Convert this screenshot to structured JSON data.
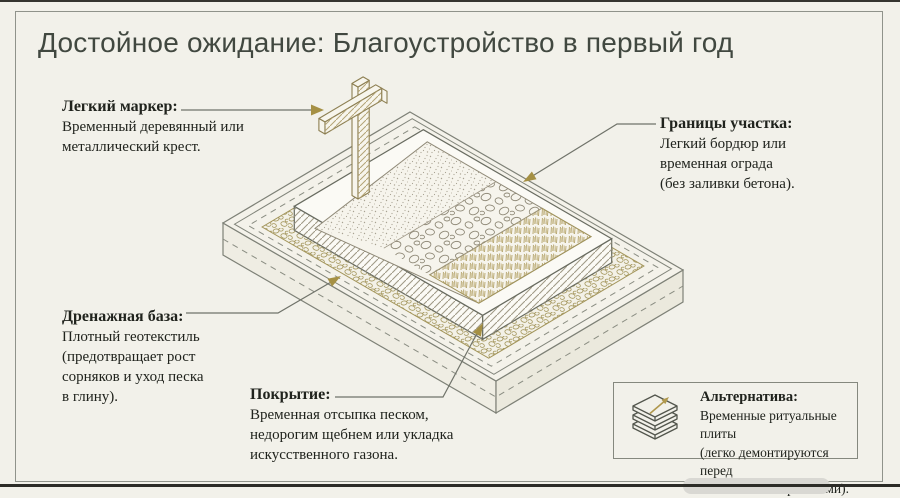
{
  "page": {
    "title": "Достойное ожидание: Благоустройство в первый год"
  },
  "callouts": {
    "marker": {
      "heading": "Легкий маркер:",
      "lines": [
        "Временный деревянный или",
        "металлический крест."
      ]
    },
    "plot_borders": {
      "heading": "Границы участка:",
      "lines": [
        "Легкий бордюр или",
        "временная ограда",
        "(без заливки бетона)."
      ]
    },
    "drainage": {
      "heading": "Дренажная база:",
      "lines": [
        "Плотный геотекстиль",
        "(предотвращает рост",
        "сорняков и уход песка",
        "в глину)."
      ]
    },
    "covering": {
      "heading": "Покрытие:",
      "lines": [
        "Временная отсыпка песком,",
        "недорогим щебнем или укладка",
        "искусственного газона."
      ]
    },
    "alternative": {
      "heading": "Альтернатива:",
      "lines": [
        "Временные ритуальные плиты",
        "(легко демонтируются перед",
        "капитальными работами)."
      ]
    }
  },
  "icons": {
    "cross": "wooden-cross-icon",
    "stacked_slabs": "stacked-slabs-icon",
    "arrow_up_right": "arrow-up-right-icon",
    "leader_arrowhead": "gold-triangle-arrowhead"
  },
  "colors": {
    "background": "#f2f1ea",
    "frame_border": "#90938b",
    "title_text": "#414840",
    "body_text": "#20231d",
    "line_gray": "#70736a",
    "accent_gold": "#a8975a"
  }
}
